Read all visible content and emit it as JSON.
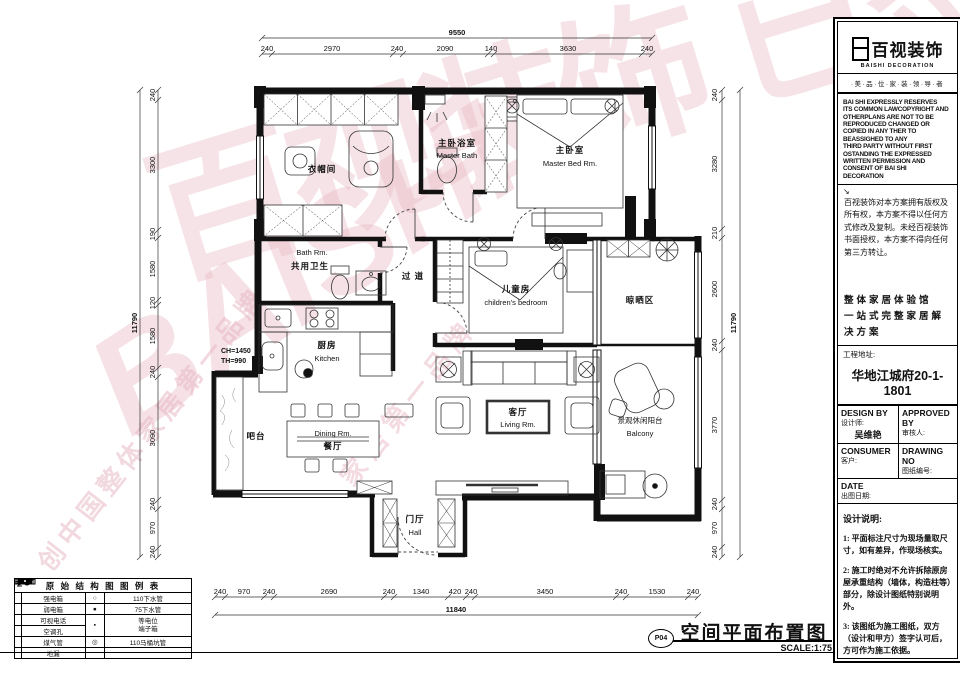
{
  "watermark": {
    "brand_cn": "百视装饰 已签约",
    "brand_en": "BAISHI",
    "tagline_1": "创中国整体家居第一品牌",
    "tagline_2": "家居第一品牌"
  },
  "plan": {
    "rooms": {
      "cloakroom": {
        "cn": "衣帽间"
      },
      "master_bath": {
        "cn": "主卧浴室",
        "en": "Master Bath"
      },
      "master_bed": {
        "cn": "主卧室",
        "en": "Master Bed Rm."
      },
      "shared_bath": {
        "en": "Bath Rm.",
        "cn": "共用卫生"
      },
      "corridor": {
        "cn": "过 道"
      },
      "kids": {
        "cn": "儿童房",
        "en": "children's bedroom"
      },
      "drying": {
        "cn": "晾晒区"
      },
      "kitchen": {
        "cn": "厨房",
        "en": "Kitchen"
      },
      "bar": {
        "cn": "吧台"
      },
      "dining": {
        "en": "Dining Rm.",
        "cn": "餐厅"
      },
      "living": {
        "cn": "客厅",
        "en": "Living Rm."
      },
      "balcony": {
        "cn": "景观休闲阳台",
        "en": "Balcony"
      },
      "hall": {
        "cn": "门厅",
        "en": "Hall"
      }
    },
    "annotation_ch": "CH=1450",
    "annotation_th": "TH=990",
    "dims": {
      "top_total": "9550",
      "top": [
        "240",
        "2970",
        "240",
        "2090",
        "140",
        "3630",
        "240"
      ],
      "bottom": [
        "240",
        "970",
        "240",
        "2690",
        "240",
        "1340",
        "420",
        "240",
        "3450",
        "240",
        "1530",
        "240"
      ],
      "bottom_total": "11840",
      "left_total": "11790",
      "left": [
        "240",
        "3300",
        "190",
        "1580",
        "120",
        "1580",
        "240",
        "3090",
        "240",
        "970",
        "240"
      ],
      "right": [
        "240",
        "3280",
        "210",
        "2600",
        "240",
        "3770",
        "240",
        "970",
        "240"
      ],
      "right_total": "11790"
    }
  },
  "legend": {
    "title": "原 始 结 构 图 图 例 表",
    "rows": [
      {
        "label": "强电箱",
        "rsym": "○",
        "rlabel": "110下水管"
      },
      {
        "label": "弱电箱",
        "rsym": "●",
        "rlabel": "75下水管"
      },
      {
        "label": "可视电话",
        "rsym": "▪",
        "rlabel": "等电位\n端子箱"
      },
      {
        "label": "空调孔",
        "rsym": "",
        "rlabel": ""
      },
      {
        "label": "煤气管",
        "rsym": "◎",
        "rlabel": "110马桶坑管"
      },
      {
        "label": "地漏",
        "rsym": "",
        "rlabel": ""
      }
    ]
  },
  "sidebar": {
    "logo_cn": "百视装饰",
    "logo_en": "BAISHI DECORATION",
    "tagline": "·美·品·位·家·装·领·导·者",
    "copyright_en": "BAI SHI EXPRESSLY RESERVES\nITS COMMON LAWCOPYRIGHT AND\nOTHERPLANS ARE NOT TO BE\nREPRODUCED CHANGED OR\nCOPIED IN ANY THER TO\nBEASSIGHED TO ANY\nTHIRD PARTY WITHOUT FIRST\nOSTANDING THE EXPRESSED\nWRITTEN PERMISSION AND\nCONSENT OF BAI SHI\nDECORATION",
    "copyright_arrow": "↘",
    "copyright_cn": "百视装饰对本方案拥有版权及所有权，本方案不得以任何方式修改及复制。未经百视装饰书面授权，本方案不得向任何第三方转让。",
    "slogan_1": "整体家居体验馆",
    "slogan_2": "一站式完整家居解决方案",
    "project_label": "工程地址:",
    "project_name": "华地江城府20-1-1801",
    "design_by": "DESIGN BY",
    "designer_label": "设计师:",
    "designer_name": "吴维艳",
    "approved_by": "APPROVED BY",
    "approver_label": "审核人:",
    "consumer": "CONSUMER",
    "client_label": "客户:",
    "drawing_no": "DRAWING NO",
    "drawing_no_label": "图纸编号:",
    "date": "DATE",
    "date_label": "出图日期:",
    "notes_title": "设计说明:",
    "note_1": "1: 平面标注尺寸为现场量取尺寸，如有差异，作现场核实。",
    "note_2": "2: 施工时绝对不允许拆除原房屋承重结构（墙体，构造柱等）部分，除设计图纸特别说明外。",
    "note_3": "3: 该图纸为施工图纸，双方（设计和甲方）签字认可后，方可作为施工依据。",
    "thanks_1": "感谢您对我们",
    "thanks_2": "工作的支持与帮助！"
  },
  "footer": {
    "number": "P04",
    "title": "空间平面布置图",
    "scale": "SCALE:1:75"
  }
}
